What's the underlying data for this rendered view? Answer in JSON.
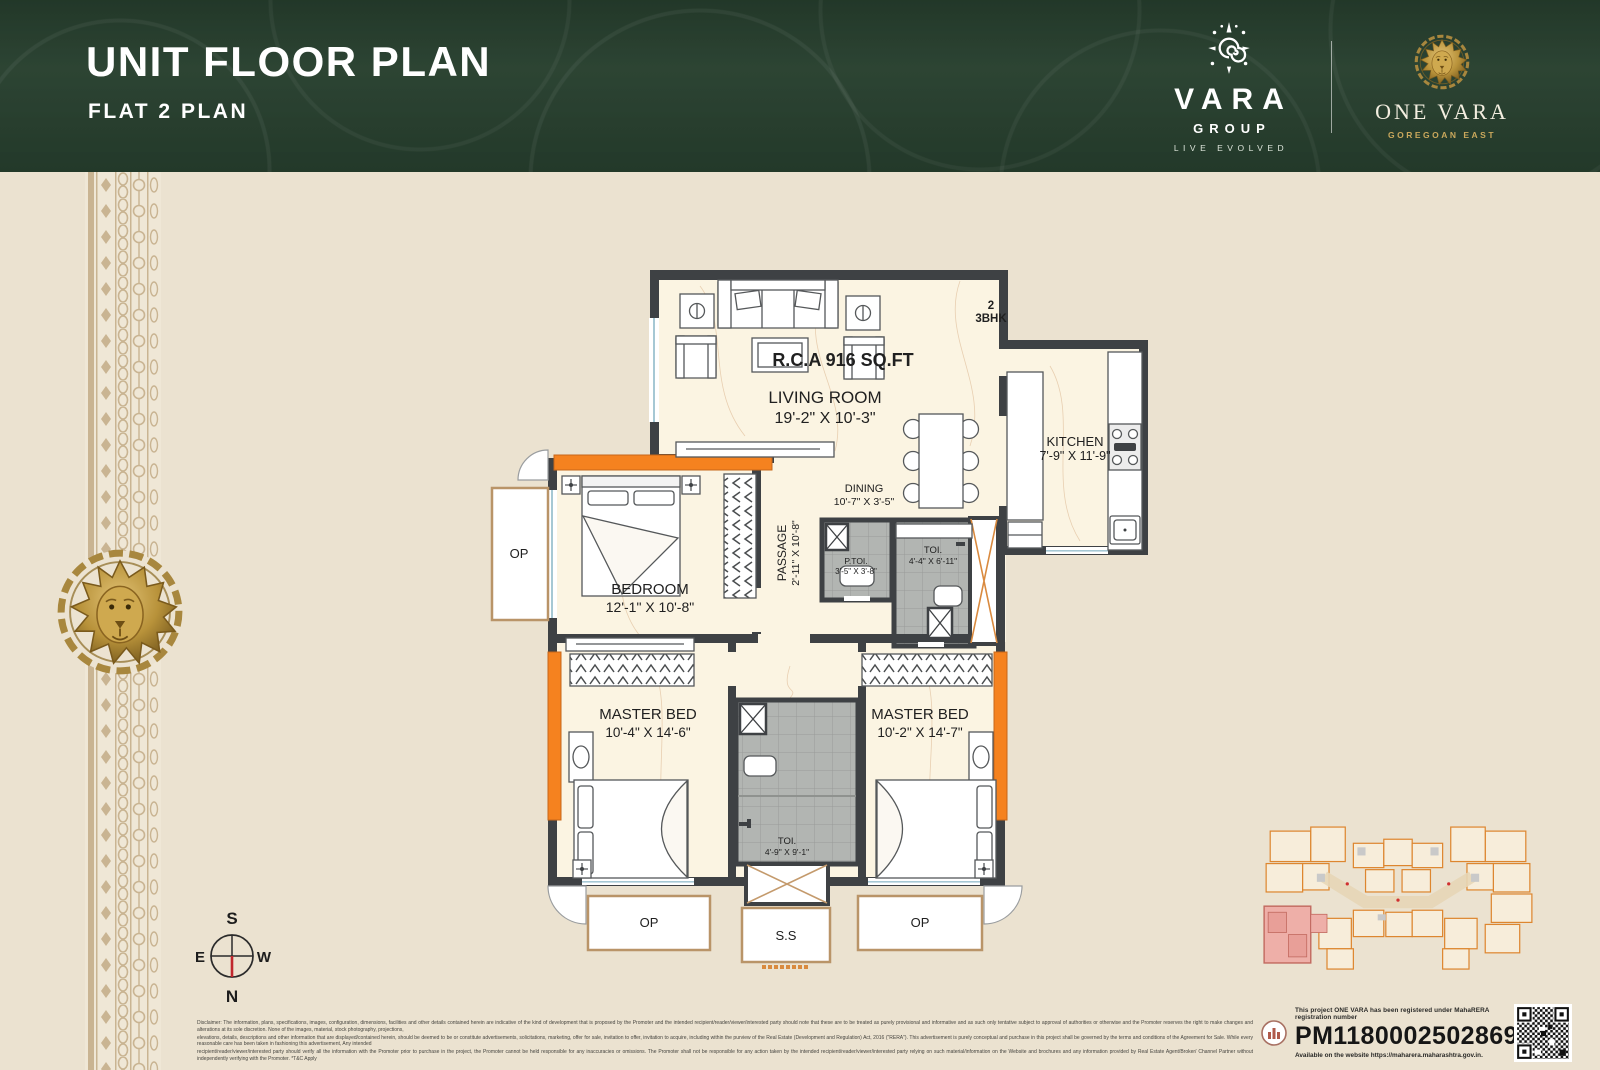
{
  "header": {
    "title": "UNIT FLOOR PLAN",
    "subtitle": "FLAT 2 PLAN"
  },
  "brand": {
    "vara_name": "VARA",
    "vara_sub": "GROUP",
    "vara_tagline": "LIVE EVOLVED",
    "project_name": "ONE VARA",
    "project_location": "GOREGOAN EAST"
  },
  "plan": {
    "unit_number": "2",
    "unit_type": "3BHK",
    "rca": "R.C.A 916 SQ.FT",
    "rooms": {
      "living": {
        "label": "LIVING ROOM",
        "dims": "19'-2\" X 10'-3\""
      },
      "kitchen": {
        "label": "KITCHEN",
        "dims": "7'-9\" X 11'-9\""
      },
      "dining": {
        "label": "DINING",
        "dims": "10'-7\" X 3'-5\""
      },
      "passage": {
        "label": "PASSAGE",
        "dims": "2'-11\" X 10'-8\""
      },
      "ptoi": {
        "label": "P.TOI.",
        "dims": "3'-5\" X 3'-8\""
      },
      "toi1": {
        "label": "TOI.",
        "dims": "4'-4\" X 6'-11\""
      },
      "bedroom": {
        "label": "BEDROOM",
        "dims": "12'-1\" X 10'-8\""
      },
      "master1": {
        "label": "MASTER BED",
        "dims": "10'-4\" X 14'-6\""
      },
      "master2": {
        "label": "MASTER BED",
        "dims": "10'-2\" X 14'-7\""
      },
      "toi2": {
        "label": "TOI.",
        "dims": "4'-9\" X 9'-1\""
      }
    },
    "op_balcony": "OP",
    "op_left": "OP",
    "op_right": "OP",
    "ss": "S.S"
  },
  "compass": {
    "n": "N",
    "s": "S",
    "e": "E",
    "w": "W"
  },
  "disclaimer": {
    "line1": "Disclaimer: The information, plans, specifications, images, configuration, dimensions, facilities and other details contained herein are indicative of the kind of development that is proposed by the Promoter and the intended recipient/reader/viewer/interested party should note that these are to be treated as purely provisional and informative and as such only tentative subject to approval of authorities or otherwise and the Promoter reserves the right to make changes and alterations at its sole discretion. None of the images, material, stock photography, projections,",
    "line2": "elevations, details, descriptions and other information that are displayed/contained herein, should be deemed to be or constitute advertisements, solicitations, marketing, offer for sale, invitation to offer, invitation to acquire, including within the purview of the Real Estate (Development and Regulation) Act, 2016 (\"RERA\"). This advertisement is purely conceptual and purchase in this project shall be governed by the terms and conditions of the Agreement for Sale. While every reasonable care has been taken in fashioning this advertisement, Any intended",
    "line3": "recipient/reader/viewer/interested party should verify all the information with the Promoter prior to purchase in the project, the Promoter cannot be held responsible for any inaccuracies or omissions. The Promoter shall not be responsible for any action taken by the intended recipient/reader/viewer/interested party relying on such material/information on the Website and brochures and any information provided by Real Estate Agent/Broker/ Channel Partner without independently verifying with the Promoter. *T&C Apply"
  },
  "rera": {
    "intro": "This project ONE VARA has been registered under MahaRERA registration number",
    "number": "PM1180002502869,",
    "website": "Available on the website https://maharera.maharashtra.gov.in."
  },
  "colors": {
    "header_green": "#273f2e",
    "body_beige": "#ebe2d0",
    "accent_orange": "#f5821f",
    "highlight_red": "#e41e26",
    "wall_gray": "#3e4144",
    "gold": "#b8923a"
  }
}
